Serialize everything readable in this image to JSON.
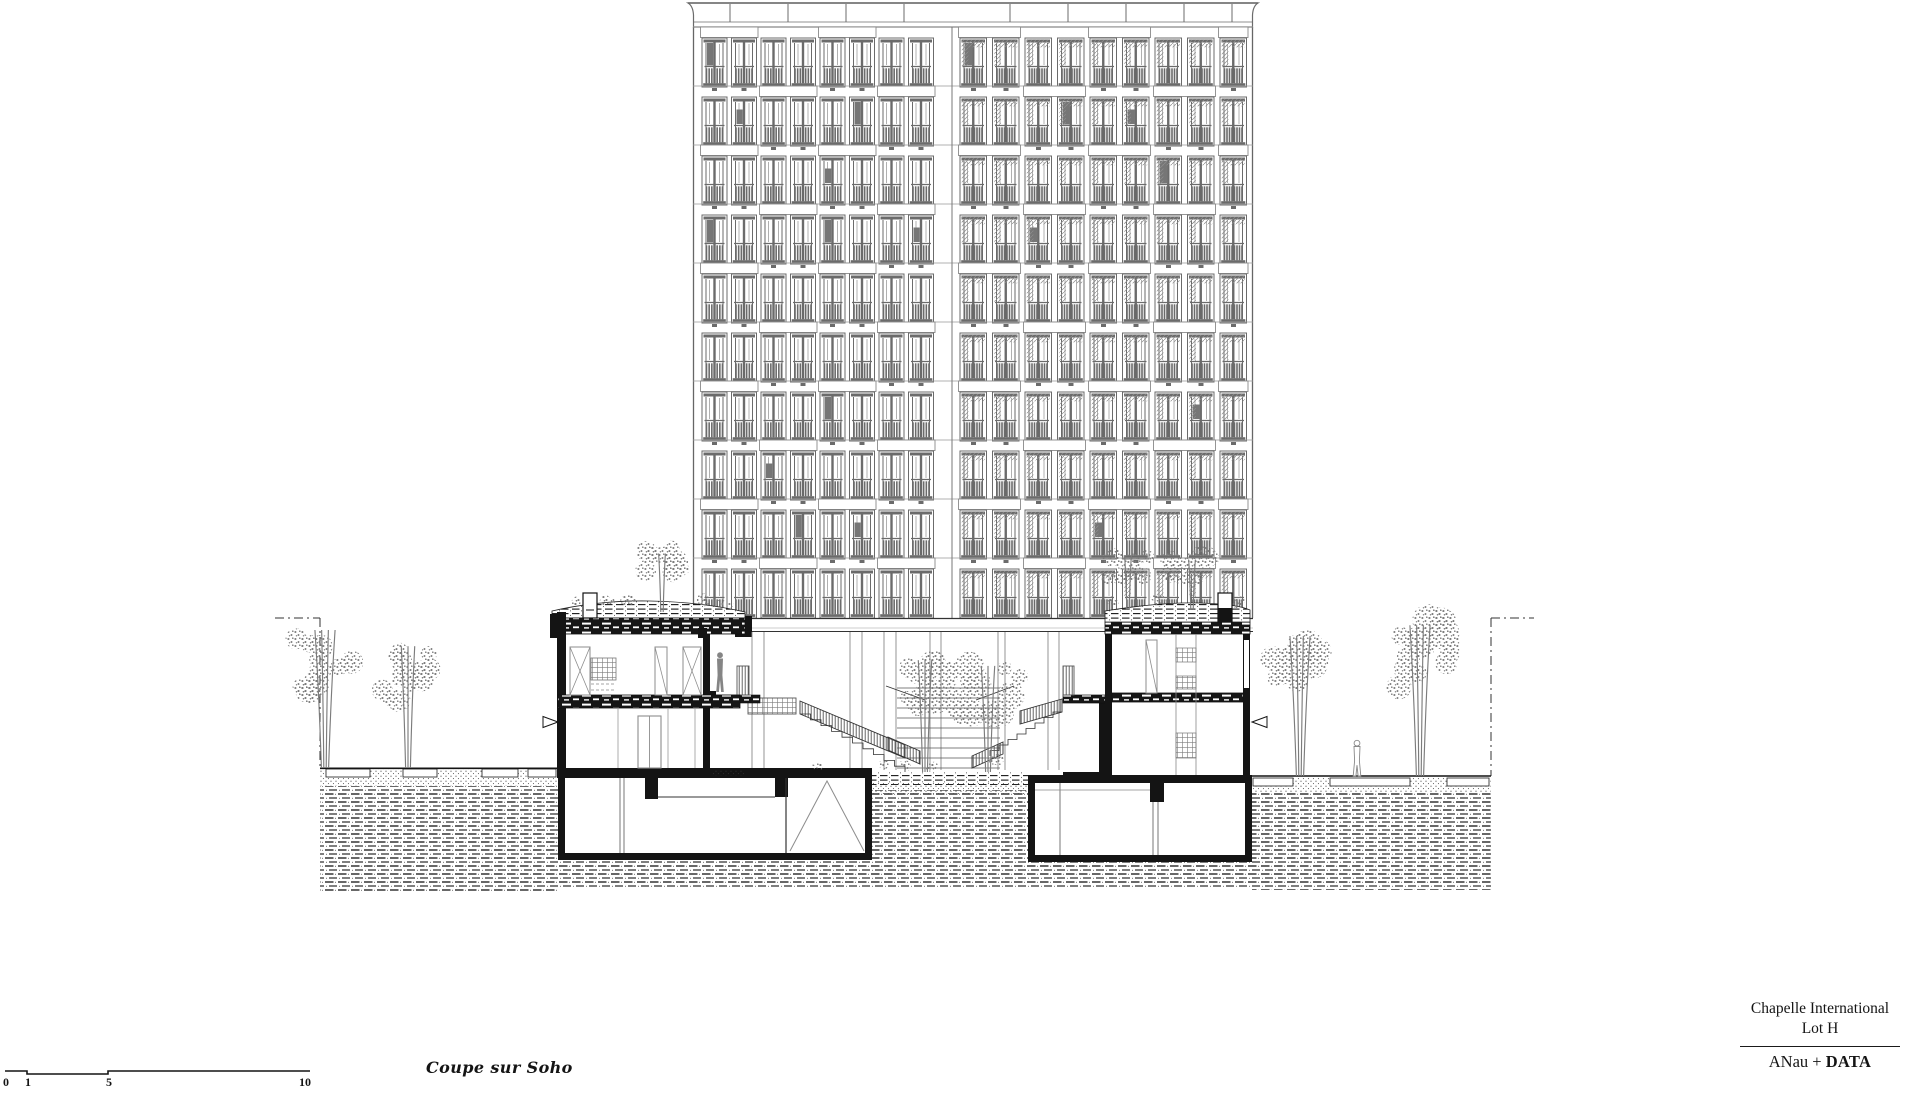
{
  "drawing": {
    "caption": "Coupe sur Soho",
    "scale_bar": {
      "labels": [
        "0",
        "1",
        "5",
        "10"
      ]
    },
    "title_block": {
      "project_line1": "Chapelle International",
      "project_line2": "Lot H",
      "firm_regular": "ANau + ",
      "firm_bold": "DATA"
    }
  },
  "colors": {
    "paper": "#ffffff",
    "ink": "#141414",
    "line_gray": "#6b6b6b",
    "light_gray": "#8f8f8f",
    "vegetation": "#7c7c7c"
  }
}
